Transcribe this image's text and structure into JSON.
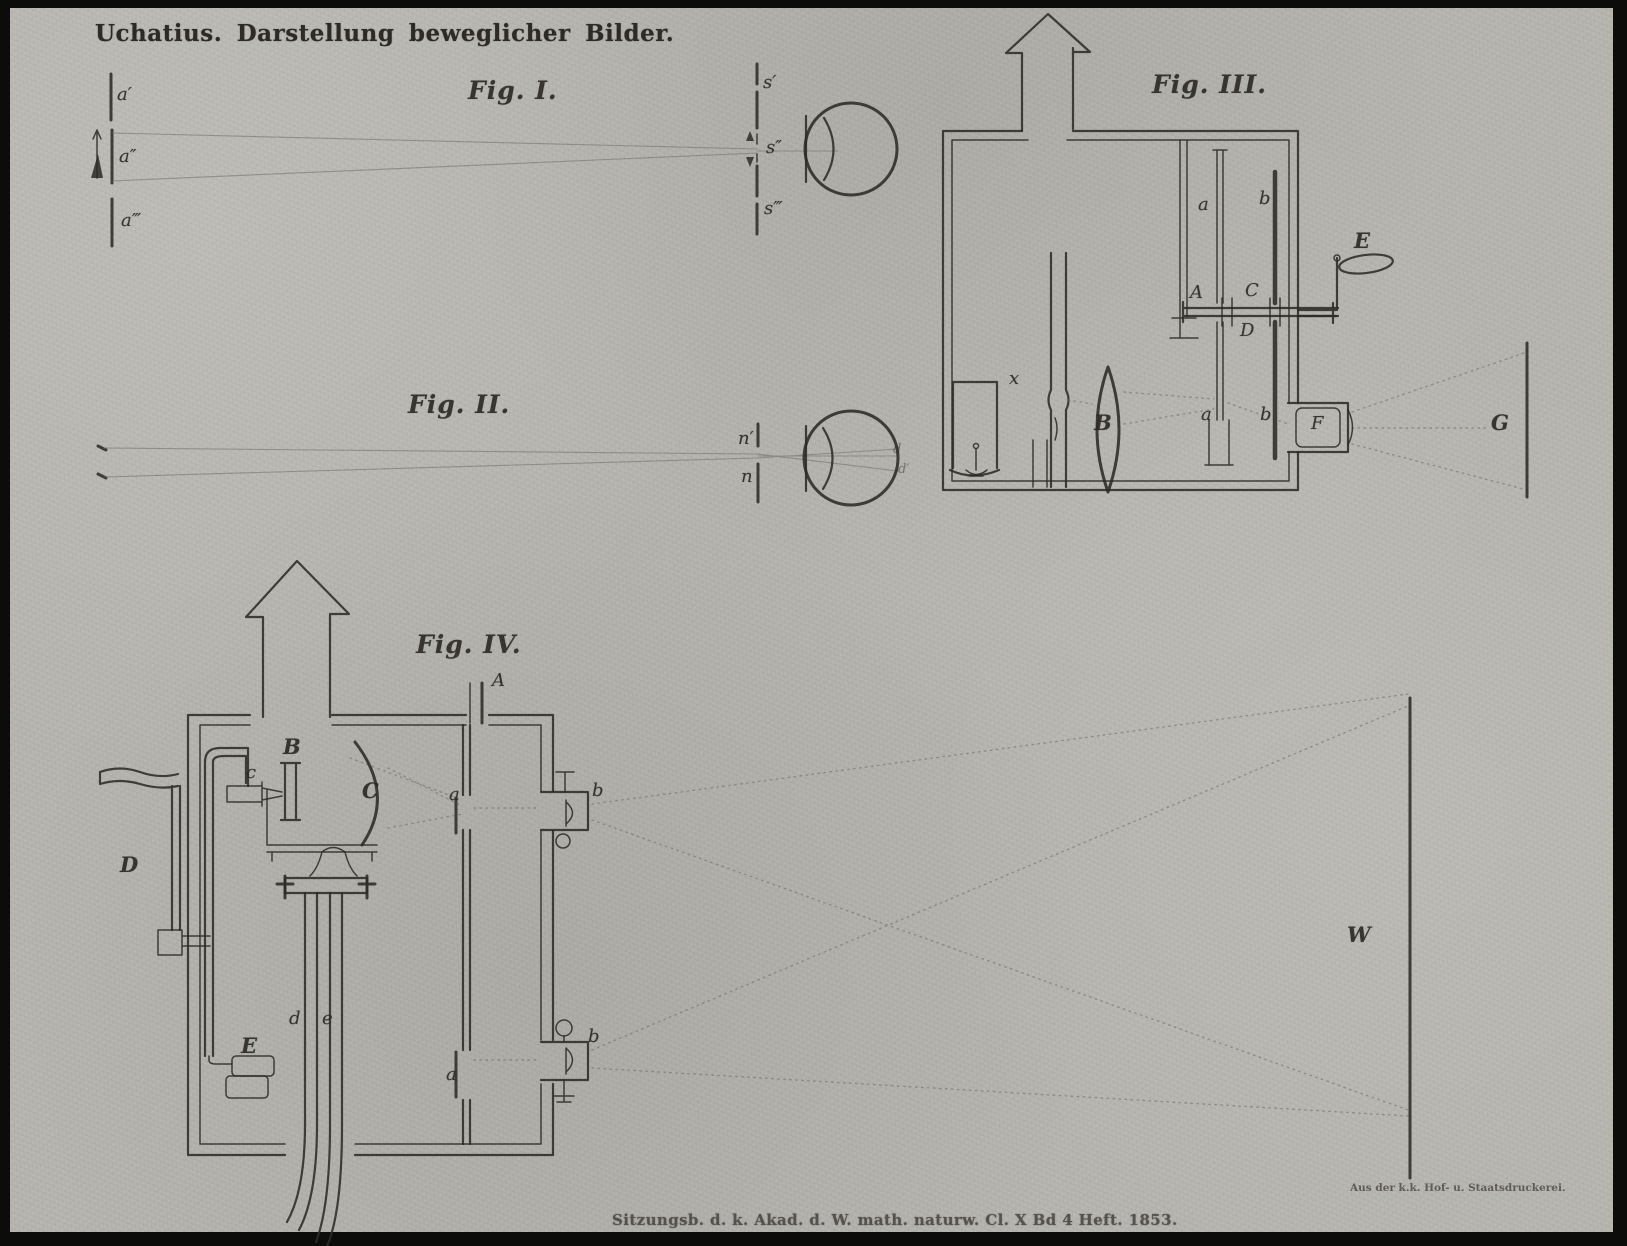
{
  "page": {
    "header_title": "Uchatius.  Darstellung beweglicher Bilder.",
    "footer_caption": "Sitzungsb. d. k. Akad. d. W. math. naturw. Cl. X Bd 4 Heft. 1853.",
    "printer_credit": "Aus der k.k. Hof- u. Staatsdruckerei.",
    "colors": {
      "paper": "#b6b5af",
      "ink": "#2e2b26",
      "faint": "#6e6b62"
    }
  },
  "fig1": {
    "title": "Fig. I.",
    "labels": {
      "a1": "a′",
      "a2": "a″",
      "a3": "a‴",
      "s1": "s′",
      "s2": "s″",
      "s3": "s‴"
    }
  },
  "fig2": {
    "title": "Fig. II.",
    "labels": {
      "n1": "n′",
      "n2": "n",
      "d1": "d",
      "d2": "d′"
    }
  },
  "fig3": {
    "title": "Fig. III.",
    "labels": {
      "band_upper": "a",
      "shutter_upper": "b",
      "frame": "A",
      "carrier": "C",
      "guide": "D",
      "crank": "E",
      "condenser": "B",
      "lamp_box": "x",
      "band_lower": "a",
      "shutter_lower": "b",
      "objective": "F",
      "screen": "G"
    }
  },
  "fig4": {
    "title": "Fig. IV.",
    "labels": {
      "slit": "A",
      "lime": "B",
      "reflector": "C",
      "jet": "c",
      "crank": "D",
      "bellows": "E",
      "tube_d": "d",
      "tube_e": "e",
      "band_upper": "a",
      "band_lower": "a",
      "prism_upper": "b",
      "prism_lower": "b",
      "screen": "W"
    }
  }
}
